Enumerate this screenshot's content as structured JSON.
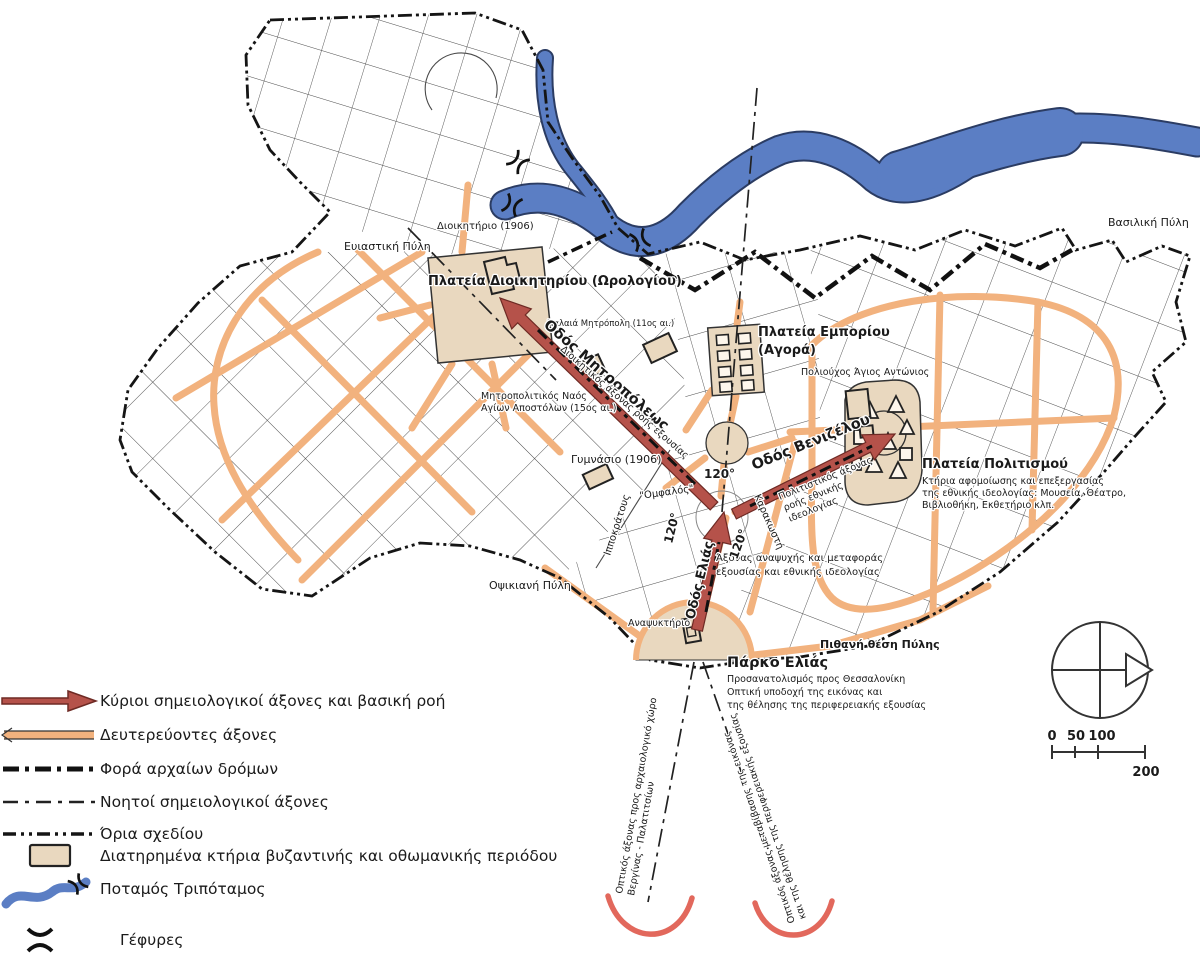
{
  "map": {
    "labels": {
      "dioikitirio": "Διοικητήριο (1906)",
      "eviastiki_pyli": "Ευιαστική Πύλη",
      "plateia_dioikitiriou": "Πλατεία Διοικητηρίου (Ωρολογίου)",
      "palaia_mitropoli": "Παλαιά Μητρόπολη (11ος αι.)",
      "odos_mitropoleos": "Οδός Μητροπόλεως",
      "dioikitikos_axonas": "Διοικητικός άξονας ροής εξουσίας",
      "mitropolitikos_naos_1": "Μητροπολιτικός Ναός",
      "mitropolitikos_naos_2": "Αγίων Αποστόλων (15ος αι.)",
      "gymnasio": "Γυμνάσιο (1906)",
      "omfalos": "\"Ομφαλός\"",
      "ippokratous": "Ιπποκράτους",
      "karakosti": "Καρακωστή",
      "odos_elias": "Οδός Ελιάς",
      "odos_venizelou": "Οδός Βενιζέλου",
      "politistikos_axonas_1": "Πολιτιστικός άξονας",
      "politistikos_axonas_2": "ροής εθνικής",
      "politistikos_axonas_3": "ιδεολογίας",
      "axonas_anapsyxis_1": "Άξονας αναψυχής και μεταφοράς",
      "axonas_anapsyxis_2": "εξουσίας και εθνικής ιδεολογίας",
      "plateia_emporiou": "Πλατεία Εμπορίου",
      "agora": "(Αγορά)",
      "poliouxos": "Πολιούχος Άγιος Αντώνιος",
      "plateia_politismou": "Πλατεία Πολιτισμού",
      "ktiria_1": "Κτήρια αφομοίωσης και επεξεργασίας",
      "ktiria_2": "της εθνικής ιδεολογίας: Μουσεία, Θέατρο,",
      "ktiria_3": "Βιβλιοθήκη, Εκθετήριο κλπ.",
      "vasiliki_pyli": "Βασιλική Πύλη",
      "opsikiani_pyli": "Οψικιανή Πύλη",
      "anapsyktirio": "Αναψυκτήριο",
      "pithani_thesi_pylis": "Πιθανή θέση Πύλης",
      "parko_elias": "Πάρκο Ελιάς",
      "prosanatolismos": "Προσανατολισμός προς Θεσσαλονίκη",
      "optiki_ypodoxi_1": "Οπτική υποδοχή της εικόνας και",
      "optiki_ypodoxi_2": "της θέλησης της περιφερειακής εξουσίας",
      "optikos_left_1": "Οπτικός άξονας προς αρχαιολογικό χώρο",
      "optikos_left_2": "Βεργίνας - Παλατιτσίων",
      "optikos_right_1": "Οπτικός άξονας μεταβίβασης της εικόνας",
      "optikos_right_2": "και της θέλησης της περιφερειακής εξουσίας",
      "angle_1": "120°",
      "angle_2": "120°",
      "angle_3": "120°"
    },
    "scale": {
      "t0": "0",
      "t50": "50",
      "t100": "100",
      "t200": "200"
    }
  },
  "legend": {
    "items": [
      {
        "symbol": "main-axis-arrow",
        "label": "Κύριοι σημειολογικοί άξονες και βασική ροή"
      },
      {
        "symbol": "secondary-axis",
        "label": "Δευτερεύοντες άξονες"
      },
      {
        "symbol": "ancient-roads",
        "label": "Φορά αρχαίων δρόμων"
      },
      {
        "symbol": "notional-axes",
        "label": "Νοητοί σημειολογικοί άξονες"
      },
      {
        "symbol": "plan-boundary",
        "label": "Όρια σχεδίου"
      },
      {
        "symbol": "preserved-building",
        "label": "Διατηρημένα κτήρια βυζαντινής και οθωμανικής περιόδου"
      },
      {
        "symbol": "river",
        "label": "Ποταμός Τριπόταμος"
      },
      {
        "symbol": "bridges",
        "label": "Γέφυρες"
      }
    ]
  },
  "colors": {
    "main_axis": "#b5524a",
    "secondary_axis": "#f2b27e",
    "river": "#5b7ec4",
    "plaza": "#e9d8bf",
    "view_arc": "#e2685c",
    "ink": "#1a1a1a"
  }
}
